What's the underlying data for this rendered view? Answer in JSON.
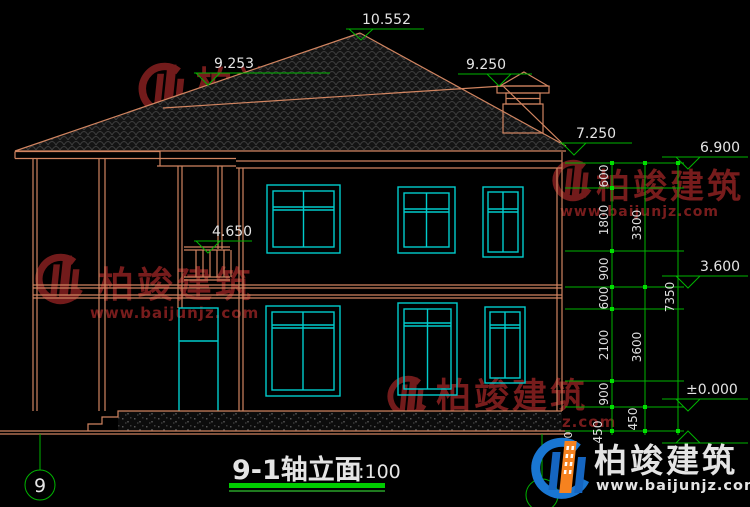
{
  "drawing": {
    "title": "9-1轴立面",
    "scale": "1:100",
    "axis_left_bubble": "9",
    "elevations": {
      "ridge": "10.552",
      "left_roof": "9.253",
      "right_roof": "9.250",
      "eave": "7.250",
      "wall_top": "6.900",
      "balcony": "4.650",
      "second_floor": "3.600",
      "ground": "±0.000"
    },
    "dimensions": {
      "chain_inner": [
        "600",
        "1800",
        "900",
        "600",
        "2100",
        "900",
        "450"
      ],
      "chain_mid": [
        "3300",
        "3600",
        "450"
      ],
      "total": "7350",
      "base": "450"
    }
  },
  "watermark": {
    "name": "柏竣建筑",
    "url": "www.baijunjz.com"
  },
  "logo": {
    "name": "柏竣建筑",
    "url": "www.baijunjz.com"
  },
  "colors": {
    "background": "#000000",
    "wall_line": "#D08460",
    "window_line": "#00CCCC",
    "dimension_line": "#00B400",
    "tick": "#00E000",
    "text": "#E4E4E4",
    "watermark_red": "#8C2222",
    "title_underline": "#00CC00",
    "logo_blue": "#1976D2",
    "logo_orange": "#F6821F",
    "logo_url_red": "#CC2525"
  }
}
